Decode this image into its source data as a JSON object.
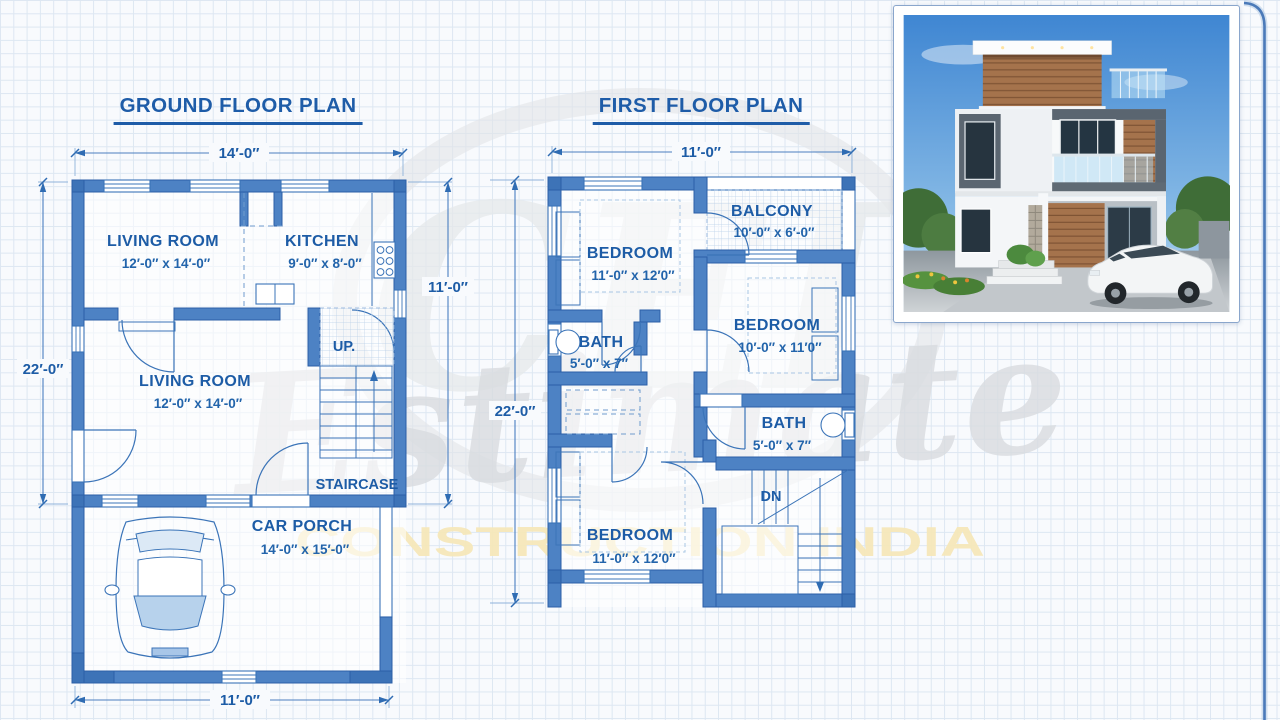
{
  "page": {
    "background": "#f8fafd",
    "grid_color": "#dde7f2",
    "wall_fill": "#4d82c4",
    "accent_blue": "#1d5ca6",
    "gold": "#f6e8ba"
  },
  "ground_floor": {
    "title": "GROUND FLOOR PLAN",
    "dims": {
      "top": "14′-0″",
      "left": "22′-0″",
      "right": "11′-0″",
      "bottom": "11′-0″"
    },
    "rooms": {
      "living_room_1": {
        "name": "LIVING ROOM",
        "size": "12′-0″ x 14′-0″"
      },
      "kitchen": {
        "name": "KITCHEN",
        "size": "9′-0″ x 8′-0″"
      },
      "living_room_2": {
        "name": "LIVING ROOM",
        "size": "12′-0″ x 14′-0″"
      },
      "staircase": {
        "name": "STAIRCASE",
        "up_label": "UP."
      },
      "car_porch": {
        "name": "CAR PORCH",
        "size": "14′-0″ x 15′-0″"
      }
    }
  },
  "first_floor": {
    "title": "FIRST FLOOR PLAN",
    "dims": {
      "top": "11′-0″",
      "left": "22′-0″"
    },
    "rooms": {
      "bedroom_1": {
        "name": "BEDROOM",
        "size": "11′-0″ x 12′0″"
      },
      "balcony": {
        "name": "BALCONY",
        "size": "10′-0″ x 6′-0″"
      },
      "bedroom_2": {
        "name": "BEDROOM",
        "size": "10′-0″ x 11′0″"
      },
      "bath_1": {
        "name": "BATH",
        "size": "5′-0″ x 7″"
      },
      "bath_2": {
        "name": "BATH",
        "size": "5′-0″ x 7″"
      },
      "bedroom_3": {
        "name": "BEDROOM",
        "size": "11′-0″ x 12′0″"
      },
      "stairs": {
        "down_label": "DN"
      }
    }
  },
  "watermark": {
    "monogram": "CEI",
    "script": "Estimate",
    "tagline": "CONSTRUCTION INDIA"
  }
}
